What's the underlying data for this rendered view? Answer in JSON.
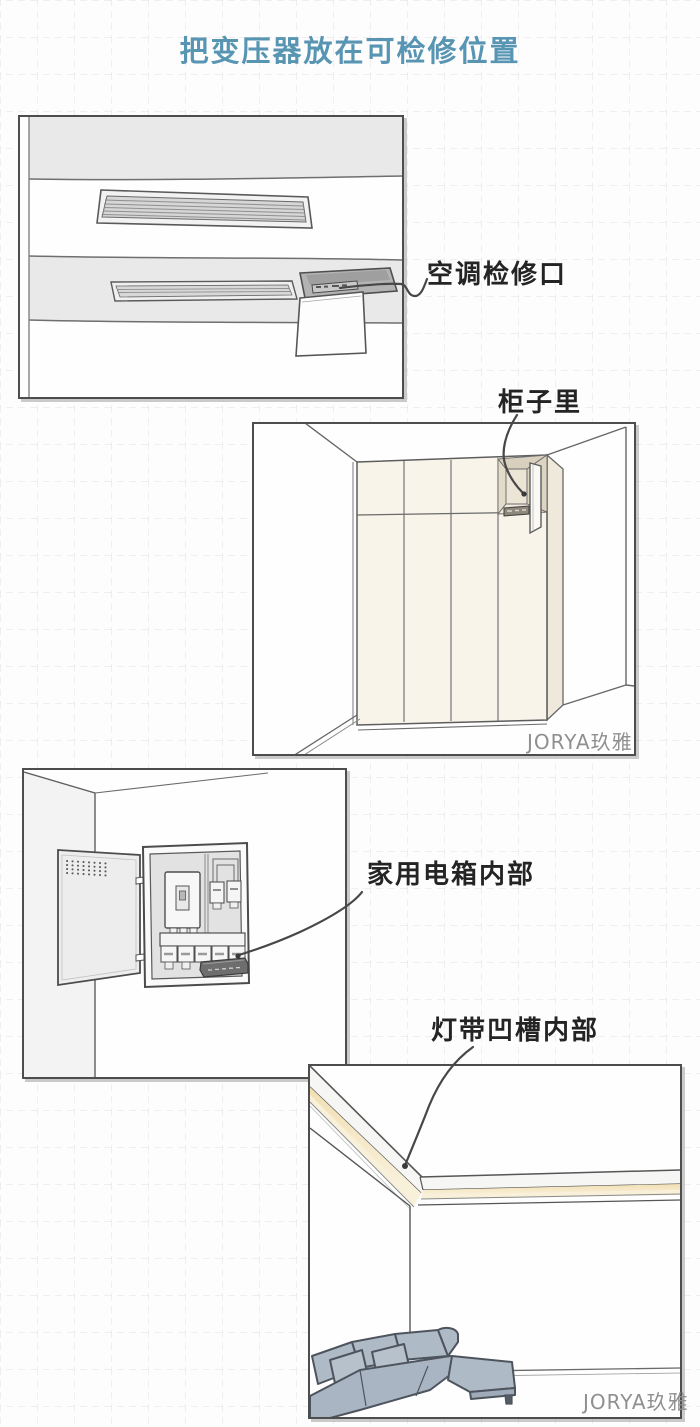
{
  "title": "把变压器放在可检修位置",
  "accent_color": "#5795b3",
  "panels": [
    {
      "name": "ac-ceiling-access",
      "label": "空调检修口"
    },
    {
      "name": "cabinet",
      "label": "柜子里",
      "watermark": "JORYA玖雅"
    },
    {
      "name": "distribution-box",
      "label": "家用电箱内部"
    },
    {
      "name": "led-cove",
      "label": "灯带凹槽内部",
      "watermark": "JORYA玖雅"
    }
  ],
  "colors": {
    "label_text": "#242424",
    "panel_border": "#4d4d4d",
    "cove_glow": "#f2e0b4",
    "sofa": "#aebac6",
    "cabinet_wood": "#f8f4ea",
    "watermark": "#8f8f8f"
  }
}
